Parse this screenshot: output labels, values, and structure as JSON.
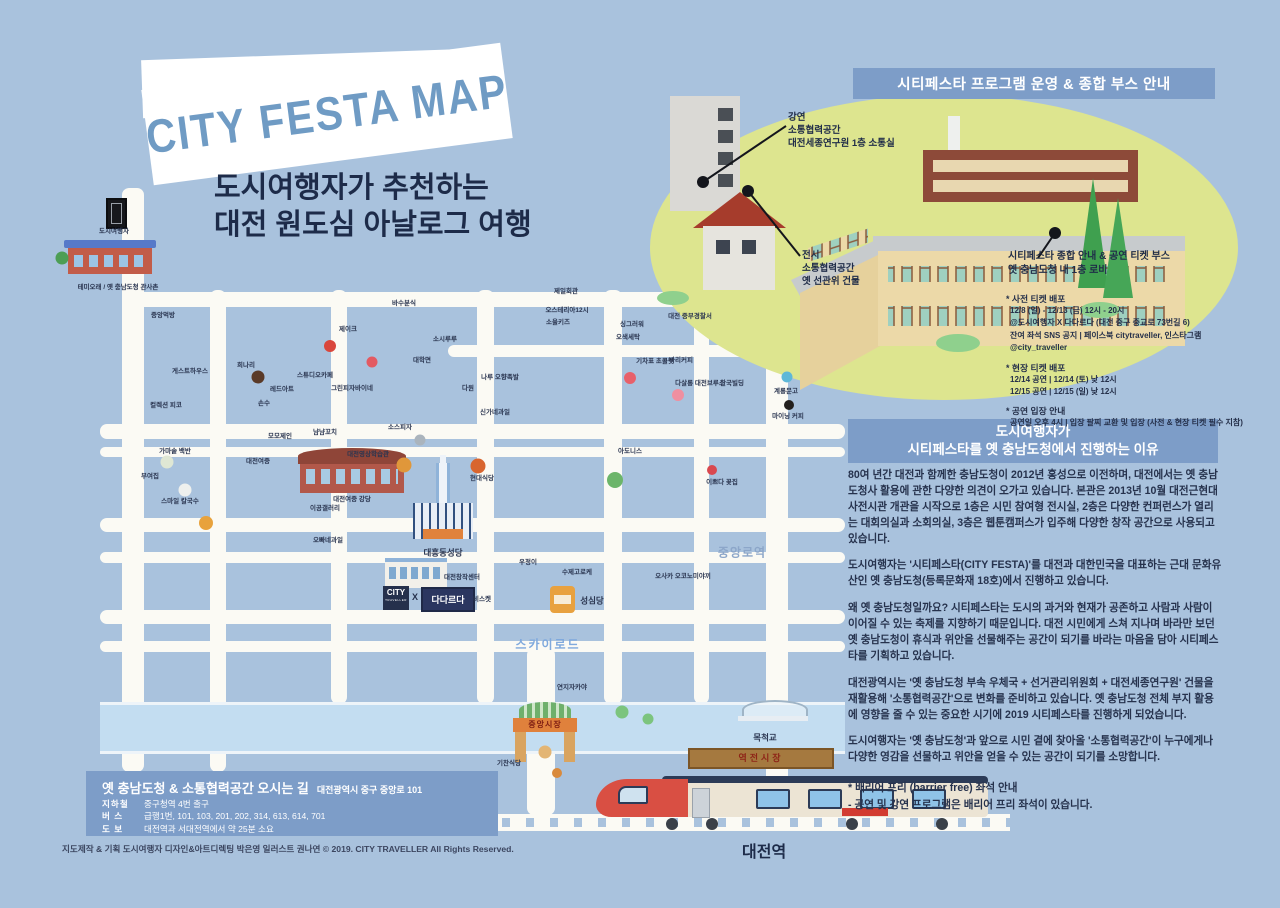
{
  "title": {
    "banner": "CITY FESTA MAP",
    "subtitle": [
      "도시여행자가 추천하는",
      "대전 원도심 아날로그 여행"
    ]
  },
  "program_panel": {
    "header": "시티페스타 프로그램 운영 & 종합 부스 안내",
    "callout_lecture": [
      "강연",
      "소통협력공간",
      "대전세종연구원 1층 소통실"
    ],
    "callout_exhibit": [
      "전시",
      "소통협력공간",
      "옛 선관위 건물"
    ],
    "callout_booth": [
      "시티페스타 종합 안내 & 공연 티켓 부스",
      "옛 충남도청 내 1층 로비"
    ],
    "tickets": [
      {
        "heading": "* 사전 티켓 배포",
        "lines": [
          "12/8 (일) - 12/13 (금) 12시 - 20시",
          "@도시여행자 X 다다르다 (대전 중구 중교로 73번길 6)",
          "잔여 좌석 SNS 공지 | 페이스북 citytraveller, 인스타그램 @city_traveller"
        ]
      },
      {
        "heading": "* 현장 티켓 배포",
        "lines": [
          "12/14 공연 | 12/14 (토) 낮 12시",
          "12/15 공연 | 12/15 (일) 낮 12시"
        ]
      },
      {
        "heading": "* 공연 입장 안내",
        "lines": [
          "공연일 오후 4시 | 입장 팔찌 교환 및 입장 (사전 & 현장 티켓 필수 지참)"
        ]
      }
    ]
  },
  "reason_panel": {
    "header": [
      "도시여행자가",
      "시티페스타를 옛 충남도청에서 진행하는 이유"
    ],
    "paragraphs": [
      "80여 년간 대전과 함께한 충남도청이 2012년 홍성으로 이전하며, 대전에서는 옛 충남도청사 활용에 관한 다양한 의견이 오가고 있습니다. 본관은 2013년 10월 대전근현대사전시관 개관을 시작으로 1층은 시민 참여형 전시실, 2층은 다양한 컨퍼런스가 열리는 대회의실과 소회의실, 3층은 웹툰캠퍼스가 입주해 다양한 창작 공간으로 사용되고 있습니다.",
      "도시여행자는 '시티페스타(CITY FESTA)'를 대전과 대한민국을 대표하는 근대 문화유산인 옛 충남도청(등록문화재 18호)에서 진행하고 있습니다.",
      "왜 옛 충남도청일까요? 시티페스타는 도시의 과거와 현재가 공존하고 사람과 사람이 이어질 수 있는 축제를 지향하기 때문입니다. 대전 시민에게 스쳐 지나며 바라만 보던 옛 충남도청이 휴식과 위안을 선물해주는 공간이 되기를 바라는 마음을 담아 시티페스타를 기획하고 있습니다.",
      "대전광역시는 '옛 충남도청 부속 우체국 + 선거관리위원회 + 대전세종연구원' 건물을 재활용해 '소통협력공간'으로 변화를 준비하고 있습니다. 옛 충남도청 전체 부지 활용에 영향을 줄 수 있는 중요한 시기에 2019 시티페스타를 진행하게 되었습니다.",
      "도시여행자는 '옛 충남도청'과 앞으로 시민 곁에 찾아올 '소통협력공간'이 누구에게나 다양한 영감을 선물하고 위안을 얻을 수 있는 공간이 되기를 소망합니다."
    ],
    "footnote": [
      "* 배리어 프리 (barrier free) 좌석 안내",
      "- 공연 및 강연 프로그램은 배리어 프리 좌석이 있습니다."
    ]
  },
  "map": {
    "street_labels": [
      {
        "text": "스카이로드",
        "x": 548,
        "y": 644,
        "cls": "sky"
      },
      {
        "text": "중앙로역",
        "x": 742,
        "y": 552,
        "cls": "station"
      }
    ],
    "poi_labels": [
      {
        "text": "테미오래 / 옛 충남도청 관사촌",
        "x": 118,
        "y": 288
      },
      {
        "text": "도시여행자",
        "x": 114,
        "y": 232
      },
      {
        "text": "중앙먹방",
        "x": 163,
        "y": 316
      },
      {
        "text": "게스트하우스",
        "x": 190,
        "y": 372
      },
      {
        "text": "컬렉션 피코",
        "x": 166,
        "y": 406
      },
      {
        "text": "가마솥 백반",
        "x": 175,
        "y": 452
      },
      {
        "text": "부여집",
        "x": 150,
        "y": 477
      },
      {
        "text": "스마일 칼국수",
        "x": 180,
        "y": 502
      },
      {
        "text": "희나리",
        "x": 246,
        "y": 366
      },
      {
        "text": "레드아트",
        "x": 282,
        "y": 390
      },
      {
        "text": "손수",
        "x": 264,
        "y": 404
      },
      {
        "text": "모모제인",
        "x": 280,
        "y": 437
      },
      {
        "text": "제이크",
        "x": 348,
        "y": 330
      },
      {
        "text": "스튜디오카페",
        "x": 315,
        "y": 376
      },
      {
        "text": "그린피자바이네",
        "x": 352,
        "y": 389
      },
      {
        "text": "냠냠꼬치",
        "x": 325,
        "y": 433
      },
      {
        "text": "소스피자",
        "x": 400,
        "y": 428
      },
      {
        "text": "바수분식",
        "x": 404,
        "y": 304
      },
      {
        "text": "소시루루",
        "x": 445,
        "y": 340
      },
      {
        "text": "대학면",
        "x": 422,
        "y": 361
      },
      {
        "text": "다원",
        "x": 468,
        "y": 389
      },
      {
        "text": "대전여중",
        "x": 258,
        "y": 462
      },
      {
        "text": "대전여중 강당",
        "x": 352,
        "y": 500
      },
      {
        "text": "대전영상학습관",
        "x": 368,
        "y": 455
      },
      {
        "text": "이공갤러리",
        "x": 325,
        "y": 509
      },
      {
        "text": "오빠네과일",
        "x": 328,
        "y": 541
      },
      {
        "text": "현대식당",
        "x": 482,
        "y": 479
      },
      {
        "text": "대흥동성당",
        "x": 443,
        "y": 553,
        "cls": "b"
      },
      {
        "text": "대전창작센터",
        "x": 462,
        "y": 578
      },
      {
        "text": "우정이",
        "x": 528,
        "y": 563
      },
      {
        "text": "비스켓",
        "x": 482,
        "y": 600
      },
      {
        "text": "수제고로케",
        "x": 577,
        "y": 573
      },
      {
        "text": "성심당",
        "x": 592,
        "y": 601,
        "cls": "b"
      },
      {
        "text": "오사카 오코노미야끼",
        "x": 683,
        "y": 577
      },
      {
        "text": "연지자카야",
        "x": 572,
        "y": 688
      },
      {
        "text": "제일회관",
        "x": 566,
        "y": 292
      },
      {
        "text": "오스테리아12시",
        "x": 567,
        "y": 311
      },
      {
        "text": "소울키즈",
        "x": 558,
        "y": 323
      },
      {
        "text": "싱그러워",
        "x": 632,
        "y": 325
      },
      {
        "text": "오색세탁",
        "x": 628,
        "y": 338
      },
      {
        "text": "대전 중부경찰서",
        "x": 690,
        "y": 317
      },
      {
        "text": "나루 오향족발",
        "x": 500,
        "y": 378
      },
      {
        "text": "신가네과일",
        "x": 495,
        "y": 413
      },
      {
        "text": "기차표 초콜릿",
        "x": 655,
        "y": 362
      },
      {
        "text": "바리커피",
        "x": 681,
        "y": 361
      },
      {
        "text": "다살롱 대전브루스",
        "x": 700,
        "y": 384
      },
      {
        "text": "한국빌딩",
        "x": 732,
        "y": 384
      },
      {
        "text": "아도니스",
        "x": 630,
        "y": 452
      },
      {
        "text": "이쁘다 꽃집",
        "x": 722,
        "y": 483
      },
      {
        "text": "계룡문고",
        "x": 786,
        "y": 392
      },
      {
        "text": "마이닝 커피",
        "x": 788,
        "y": 417
      },
      {
        "text": "기찬식당",
        "x": 509,
        "y": 764
      }
    ],
    "icons": [
      {
        "name": "soda-cup-icon",
        "x": 330,
        "y": 346,
        "s": 12,
        "c": "#d9463c"
      },
      {
        "name": "chocolate-cake-icon",
        "x": 258,
        "y": 377,
        "s": 13,
        "c": "#5a3a28"
      },
      {
        "name": "strawberry-icon",
        "x": 372,
        "y": 362,
        "s": 11,
        "c": "#e35a62"
      },
      {
        "name": "pizza-slice-icon",
        "x": 206,
        "y": 523,
        "s": 14,
        "c": "#e8a23c"
      },
      {
        "name": "soup-bowl-icon",
        "x": 167,
        "y": 462,
        "s": 13,
        "c": "#dfe7d4"
      },
      {
        "name": "noodle-bowl-icon",
        "x": 185,
        "y": 490,
        "s": 13,
        "c": "#eef0ee"
      },
      {
        "name": "pizza-icon",
        "x": 404,
        "y": 465,
        "s": 15,
        "c": "#e0973a"
      },
      {
        "name": "paella-pan-icon",
        "x": 478,
        "y": 466,
        "s": 15,
        "c": "#d8652f"
      },
      {
        "name": "cocktail-icon",
        "x": 630,
        "y": 378,
        "s": 12,
        "c": "#e8606a"
      },
      {
        "name": "squid-icon",
        "x": 678,
        "y": 395,
        "s": 12,
        "c": "#ef8fa0"
      },
      {
        "name": "fish-icon",
        "x": 420,
        "y": 440,
        "s": 11,
        "c": "#aab4bd"
      },
      {
        "name": "coffee-cup-icon",
        "x": 789,
        "y": 405,
        "s": 10,
        "c": "#23201e"
      },
      {
        "name": "bird-icon",
        "x": 787,
        "y": 377,
        "s": 11,
        "c": "#5fb8d8"
      },
      {
        "name": "donut-icon",
        "x": 545,
        "y": 752,
        "s": 13,
        "c": "#e3b574"
      },
      {
        "name": "corndog-icon",
        "x": 557,
        "y": 773,
        "s": 10,
        "c": "#d98a3c"
      },
      {
        "name": "flower-icon",
        "x": 712,
        "y": 470,
        "s": 10,
        "c": "#d9484f"
      },
      {
        "name": "tree-icon",
        "x": 615,
        "y": 480,
        "s": 16,
        "c": "#6cb56a"
      },
      {
        "name": "tree-icon",
        "x": 62,
        "y": 258,
        "s": 13,
        "c": "#4d9e55"
      },
      {
        "name": "bush-icon",
        "x": 622,
        "y": 712,
        "s": 13,
        "c": "#7cc47e"
      },
      {
        "name": "bush-icon",
        "x": 648,
        "y": 719,
        "s": 11,
        "c": "#7cc47e"
      }
    ],
    "logos": {
      "city_top": "CITY",
      "city_sub": "TRAVELLER",
      "x": "X",
      "dadareuda": "다다르다"
    },
    "market_gate": "중앙시장",
    "wooden_sign": "역전시장",
    "bridge_label": "목척교",
    "station": "대전역"
  },
  "directions_box": {
    "title": "옛 충남도청 & 소통협력공간 오시는 길",
    "address": "대전광역시 중구 중앙로 101",
    "rows": [
      {
        "label": "지하철",
        "value": "중구청역 4번 출구"
      },
      {
        "label": "버  스",
        "value": "급행1번, 101, 103, 201, 202, 314, 613, 614, 701"
      },
      {
        "label": "도  보",
        "value": "대전역과 서대전역에서 약 25분 소요"
      }
    ]
  },
  "footer": {
    "credits": "지도제작 & 기획  도시여행자     디자인&아트디렉팅  박은영     일러스트  권나연     © 2019. CITY TRAVELLER  All Rights Reserved."
  }
}
